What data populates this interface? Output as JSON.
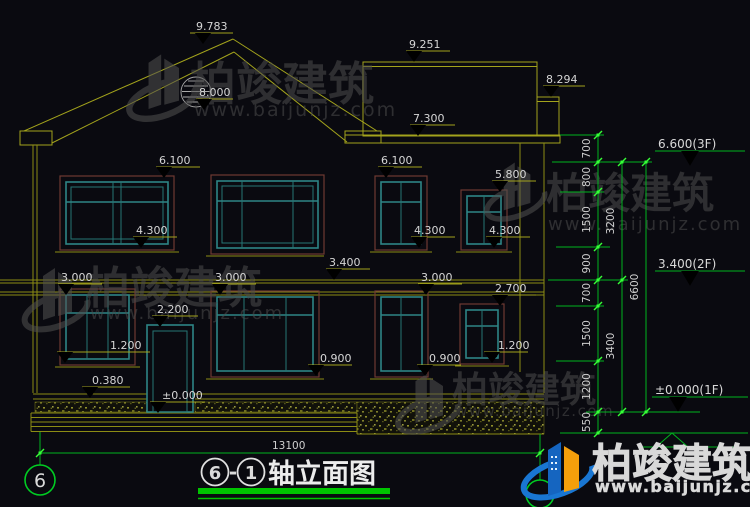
{
  "title_block": {
    "axis_start": "6",
    "separator": "-",
    "axis_end": "1",
    "name": "轴立面图"
  },
  "axis_bubbles": {
    "left": "6"
  },
  "watermarks": {
    "brand": "柏竣建筑",
    "url": "www.baijunjz.com"
  },
  "facade_markers": [
    {
      "label": "9.783"
    },
    {
      "label": "9.251"
    },
    {
      "label": "8.294"
    },
    {
      "label": "8.000"
    },
    {
      "label": "7.300"
    },
    {
      "label": "6.100"
    },
    {
      "label": "6.100"
    },
    {
      "label": "5.800"
    },
    {
      "label": "4.300"
    },
    {
      "label": "4.300"
    },
    {
      "label": "4.300"
    },
    {
      "label": "3.400"
    },
    {
      "label": "3.000"
    },
    {
      "label": "3.000"
    },
    {
      "label": "3.000"
    },
    {
      "label": "2.700"
    },
    {
      "label": "2.200"
    },
    {
      "label": "1.200"
    },
    {
      "label": "0.900"
    },
    {
      "label": "0.900"
    },
    {
      "label": "1.200"
    },
    {
      "label": "0.380"
    },
    {
      "label": "±0.000"
    }
  ],
  "right_markers": [
    {
      "label": "6.600(3F)"
    },
    {
      "label": "3.400(2F)"
    },
    {
      "label": "±0.000(1F)"
    }
  ],
  "dim_chain_small": [
    "700",
    "800",
    "1500",
    "900",
    "700",
    "1500",
    "1200",
    "550"
  ],
  "dim_chain_mid": [
    "3200",
    "3400"
  ],
  "dim_chain_total": [
    "6600"
  ],
  "dim_width": "13100"
}
